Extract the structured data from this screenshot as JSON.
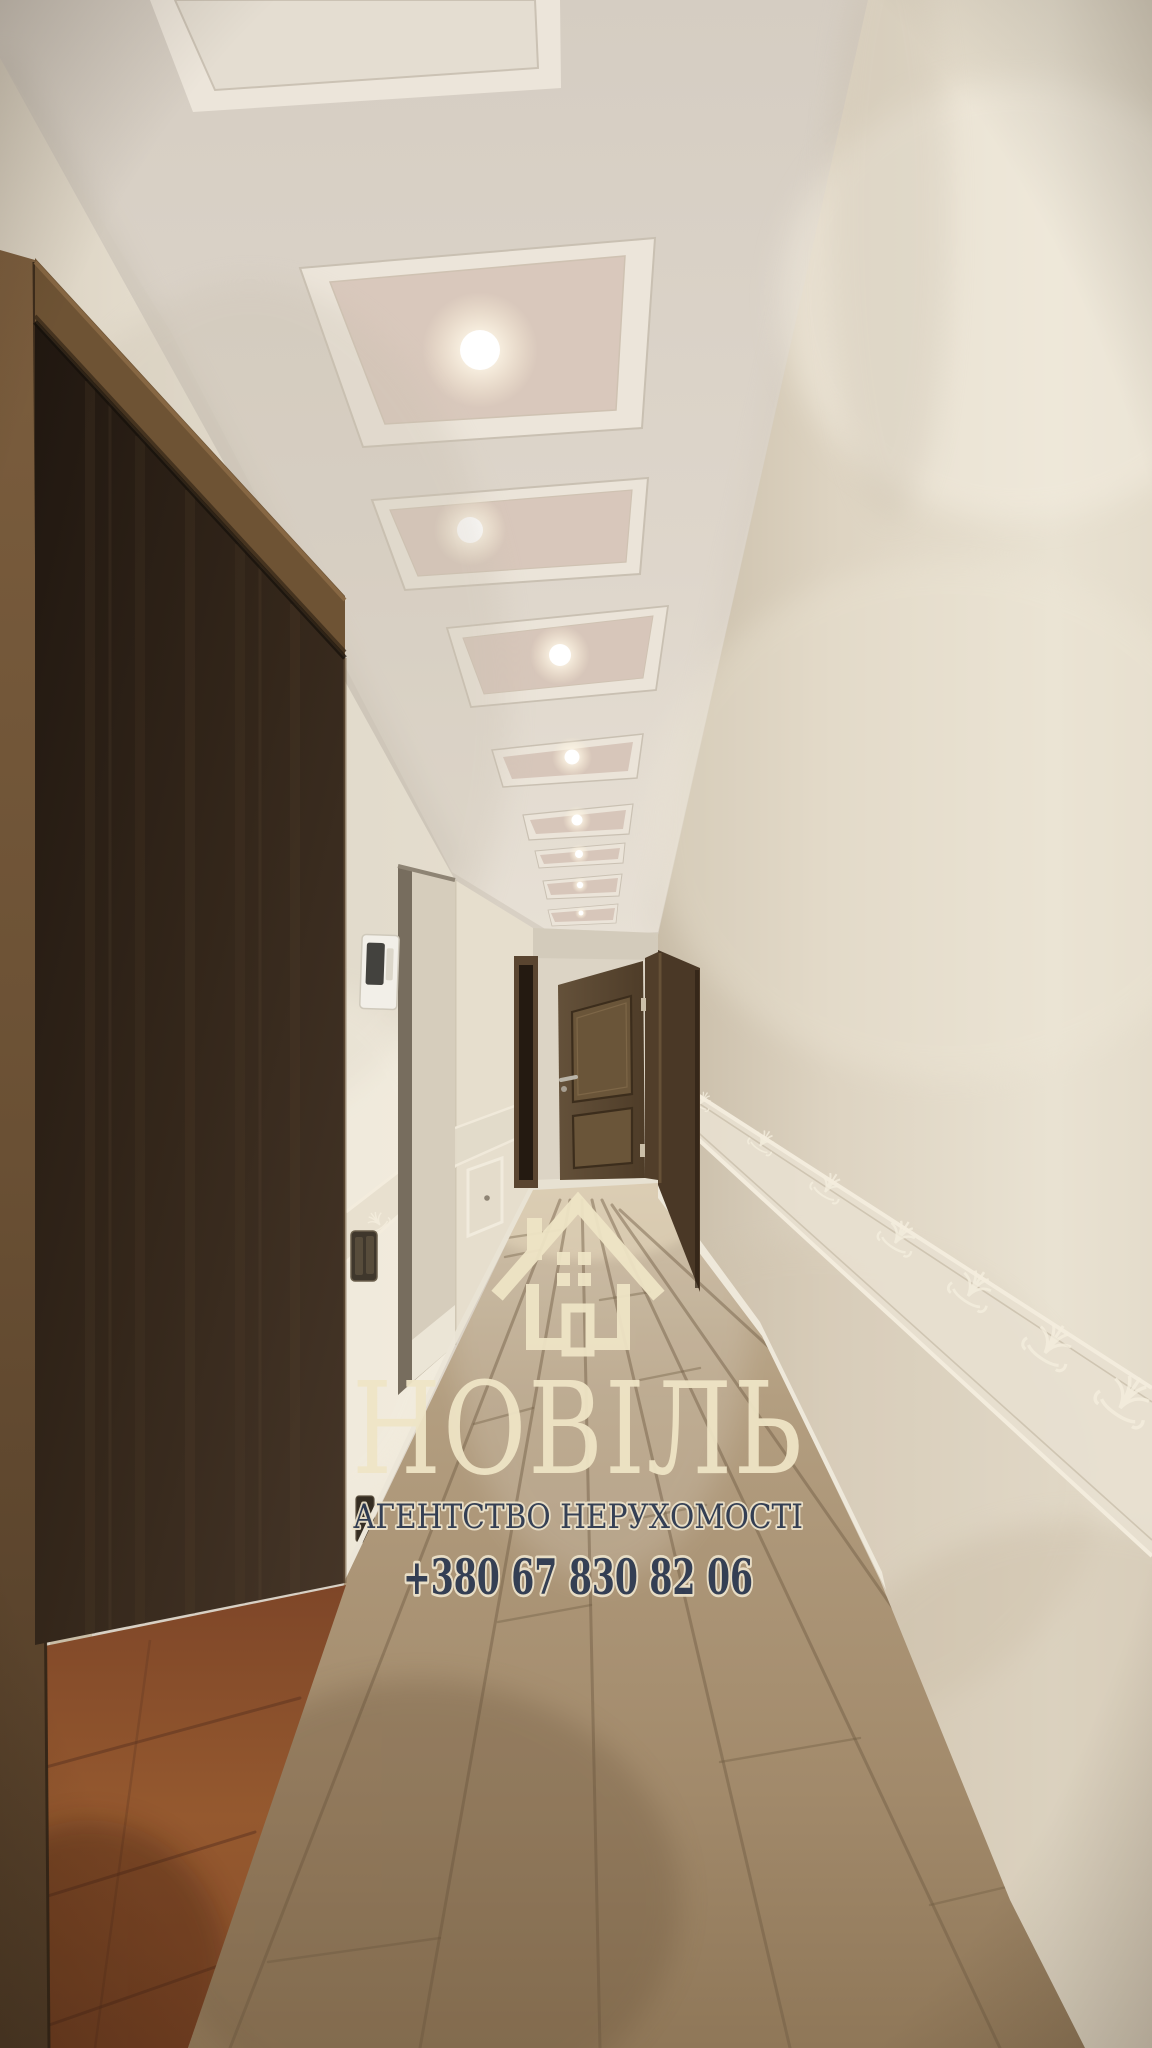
{
  "watermark": {
    "logo_icon": "house-icon",
    "brand": "НОВІЛЬ",
    "tagline": "АГЕНТСТВО НЕРУХОМОСТІ",
    "phone": "+380 67 830 82 06",
    "colors": {
      "cream": "#efe5c6",
      "navy": "#2d3a52"
    }
  }
}
